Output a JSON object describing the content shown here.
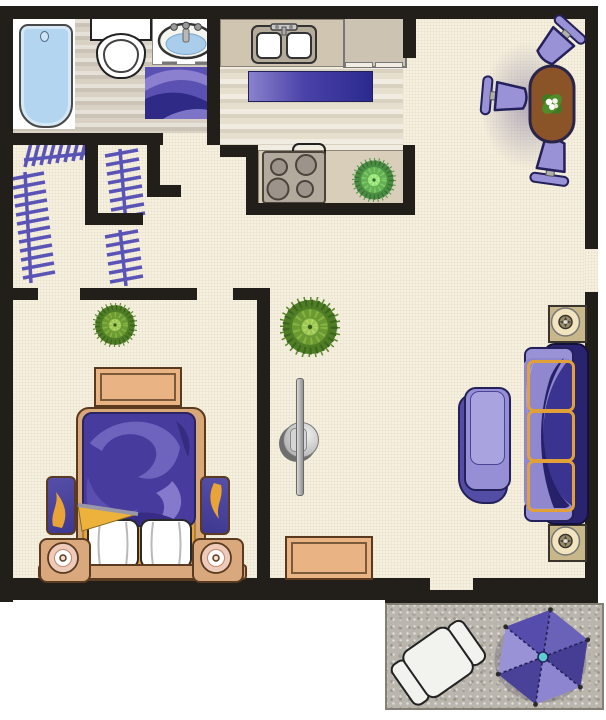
{
  "title": "one-bedroom apartment floor plan",
  "palette": {
    "wall": "#221f1b",
    "carpet": "#f6f0de",
    "bathroom_floor": "#d8d1c4",
    "kitchen_floor": "#e6dfcd",
    "patio_concrete": "#bab6ad",
    "accent_purple": "#554cab",
    "light_purple": "#9a92d6",
    "dark_purple": "#2a2470",
    "accent_orange": "#e8a437",
    "wood_tan": "#e9b384",
    "counter_tan": "#cfc5b1",
    "table_brown": "#8a5428",
    "plant_green": "#6b9a33",
    "water_blue": "#b3d5ef",
    "umbrella_teal": "#5ecdd1"
  },
  "rooms": [
    {
      "id": "bathroom",
      "fixtures": [
        "bathtub",
        "toilet",
        "vanity-sink",
        "bath-mat"
      ]
    },
    {
      "id": "closets",
      "fixtures": [
        "clothes-rod",
        "clothes-rod",
        "clothes-rod",
        "clothes-rod"
      ]
    },
    {
      "id": "kitchen",
      "fixtures": [
        "double-sink",
        "upper-counter",
        "refrigerator",
        "runner-rug",
        "stove-cooktop",
        "lower-counter",
        "counter-plant"
      ]
    },
    {
      "id": "dining-area",
      "fixtures": [
        "oval-table",
        "centerpiece-plant",
        "dining-chair",
        "dining-chair",
        "dining-chair"
      ]
    },
    {
      "id": "living-room",
      "fixtures": [
        "floor-plant",
        "floor-lamp",
        "lounge-chair",
        "sofa",
        "end-table",
        "end-table",
        "console-table"
      ]
    },
    {
      "id": "bedroom",
      "fixtures": [
        "floor-plant",
        "dresser",
        "double-bed",
        "pillow",
        "pillow",
        "stool-bench",
        "stool-bench",
        "speaker-table",
        "speaker-table"
      ]
    },
    {
      "id": "patio",
      "fixtures": [
        "patio-chair",
        "patio-umbrella"
      ]
    }
  ]
}
